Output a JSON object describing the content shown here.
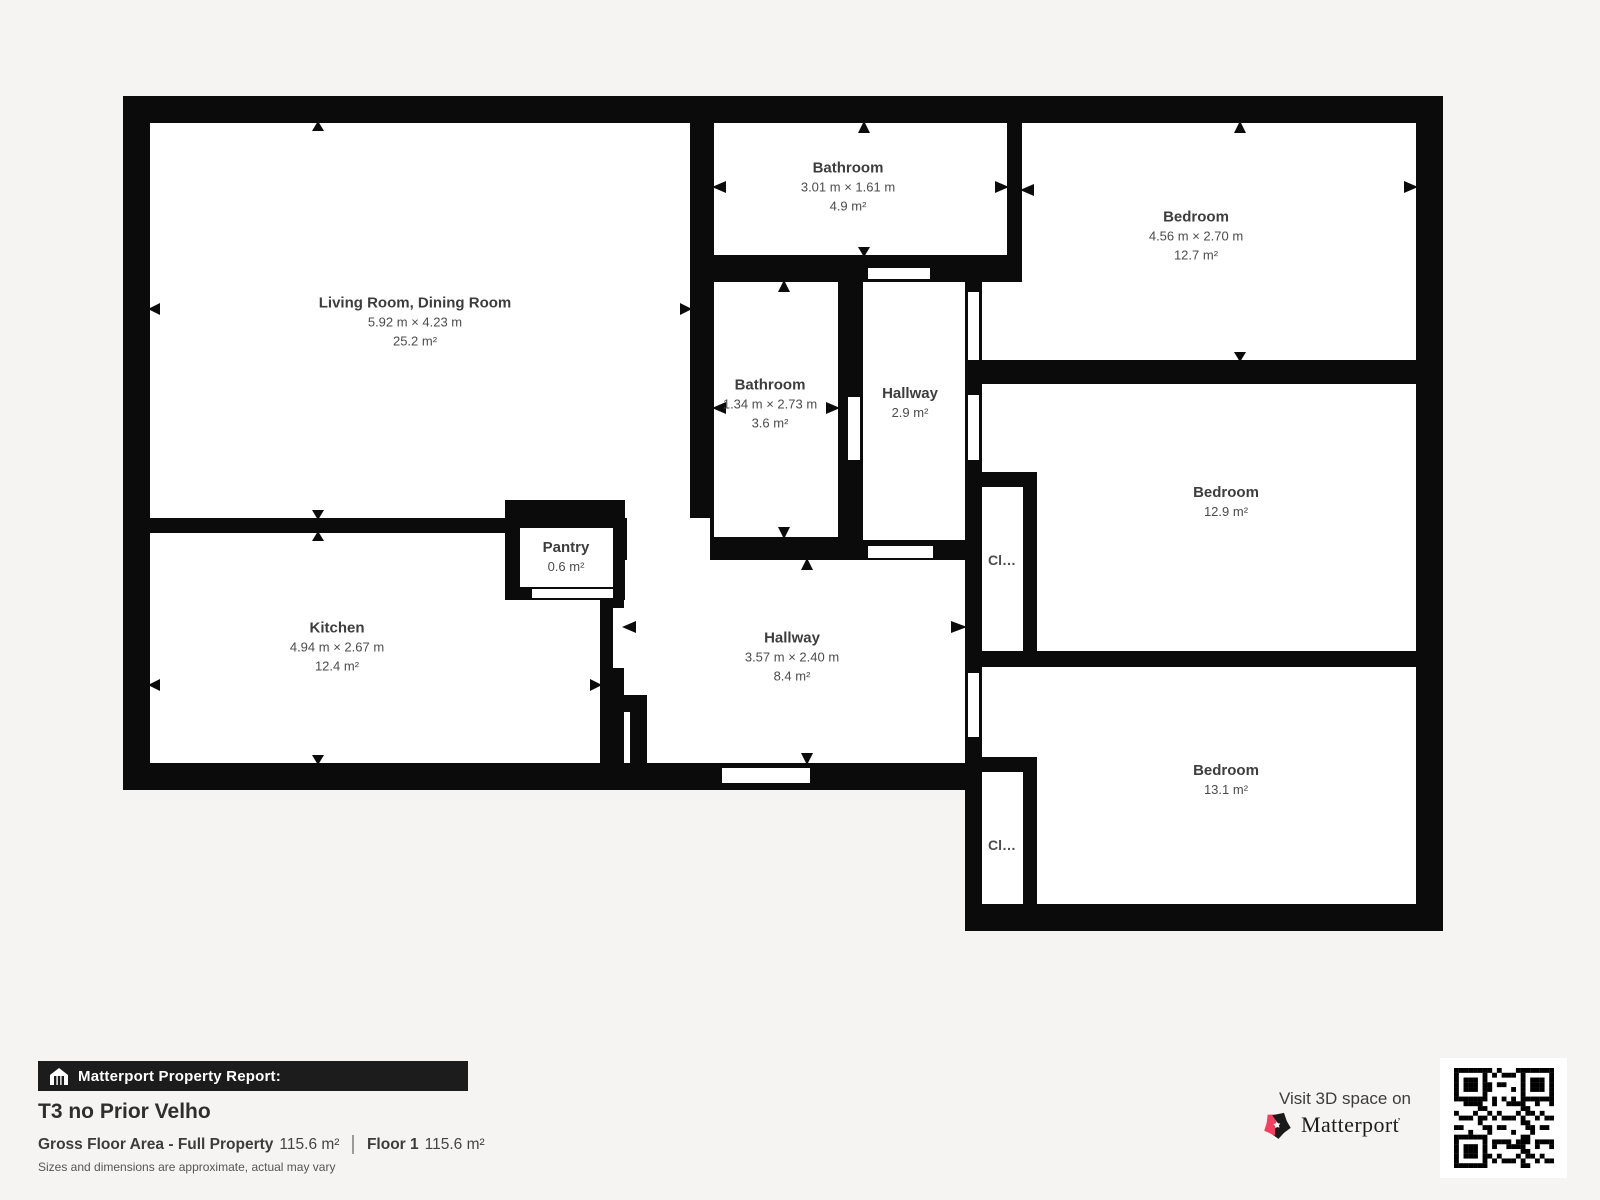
{
  "rooms": {
    "living": {
      "name": "Living Room, Dining Room",
      "dims": "5.92 m × 4.23 m",
      "area": "25.2 m²"
    },
    "bath_top": {
      "name": "Bathroom",
      "dims": "3.01 m × 1.61 m",
      "area": "4.9 m²"
    },
    "bed_top": {
      "name": "Bedroom",
      "dims": "4.56 m × 2.70 m",
      "area": "12.7 m²"
    },
    "bath_mid": {
      "name": "Bathroom",
      "dims": "1.34 m × 2.73 m",
      "area": "3.6 m²"
    },
    "hall_small": {
      "name": "Hallway",
      "area": "2.9 m²"
    },
    "bed_mid": {
      "name": "Bedroom",
      "area": "12.9 m²"
    },
    "closet_mid": {
      "name": "Cl…"
    },
    "kitchen": {
      "name": "Kitchen",
      "dims": "4.94 m × 2.67 m",
      "area": "12.4 m²"
    },
    "pantry": {
      "name": "Pantry",
      "area": "0.6 m²"
    },
    "hall_main": {
      "name": "Hallway",
      "dims": "3.57 m × 2.40 m",
      "area": "8.4 m²"
    },
    "bed_bottom": {
      "name": "Bedroom",
      "area": "13.1 m²"
    },
    "closet_bottom": {
      "name": "Cl…"
    }
  },
  "footer": {
    "report_bar": "Matterport Property Report:",
    "title": "T3 no Prior Velho",
    "gross_label": "Gross Floor Area - Full Property",
    "gross_value": "115.6 m²",
    "floor_label": "Floor 1",
    "floor_value": "115.6 m²",
    "disclaimer": "Sizes and dimensions are approximate, actual may vary"
  },
  "branding": {
    "visit": "Visit 3D space on",
    "brand": "Matterport",
    "mark": "ʼ",
    "pink": "#f43f5e",
    "wall_color": "#0b0b0b"
  }
}
